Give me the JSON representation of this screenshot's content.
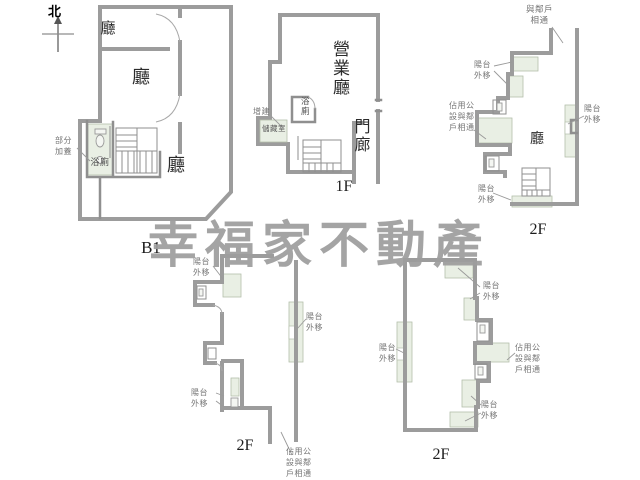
{
  "compass": {
    "north_label": "北"
  },
  "watermark": {
    "text": "幸福家不動產",
    "color": "#9e9e9e"
  },
  "plans": {
    "b1": {
      "caption": "B1",
      "room_top": "廳",
      "room_mid": "廳",
      "room_main": "廳",
      "bathroom": "浴廁",
      "note_partial_addition": "部分加蓋"
    },
    "f1": {
      "caption": "1F",
      "business_hall": "營業廳",
      "bathroom": "浴廁",
      "storage": "儲藏室",
      "note_addition": "增建",
      "porch": "門廊"
    },
    "f2_top_right": {
      "caption": "2F",
      "hall": "廳",
      "note_neighbor": "與鄰戶相通",
      "note_balcony_left": "陽台外移",
      "note_balcony_right": "陽台外移",
      "note_balcony_bottom": "陽台外移",
      "note_public": "佔用公設與鄰戶相通"
    },
    "f2_bottom_left": {
      "caption": "2F",
      "note_balcony_top": "陽台外移",
      "note_balcony_bottom": "陽台外移",
      "note_balcony_right": "陽台外移",
      "note_public": "佔用公設與鄰戶相通"
    },
    "f2_bottom_right": {
      "caption": "2F",
      "note_balcony_top": "陽台外移",
      "note_balcony_left": "陽台外移",
      "note_balcony_bottom": "陽台外移",
      "note_public": "佔用公設與鄰戶相通"
    }
  }
}
